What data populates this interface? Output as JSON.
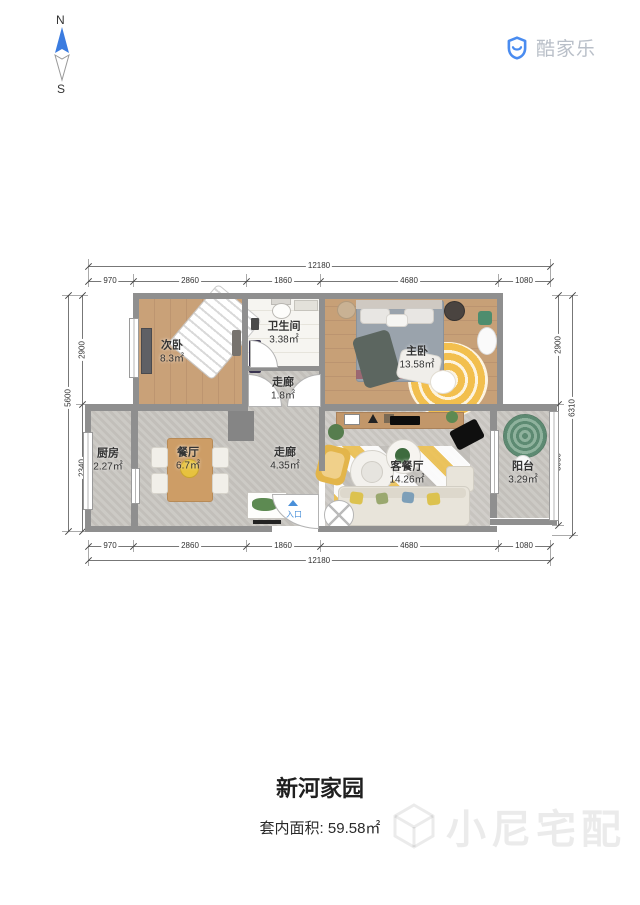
{
  "compass": {
    "north": "N",
    "south": "S"
  },
  "brand": {
    "name": "酷家乐"
  },
  "plan": {
    "rooms": {
      "second_bedroom": {
        "name": "次卧",
        "area": "8.3㎡"
      },
      "bathroom": {
        "name": "卫生间",
        "area": "3.38㎡"
      },
      "master_bedroom": {
        "name": "主卧",
        "area": "13.58㎡"
      },
      "hallway_small": {
        "name": "走廊",
        "area": "1.8㎡"
      },
      "kitchen": {
        "name": "厨房",
        "area": "2.27㎡"
      },
      "dining": {
        "name": "餐厅",
        "area": "6.7㎡"
      },
      "hallway": {
        "name": "走廊",
        "area": "4.35㎡"
      },
      "living_dining": {
        "name": "客餐厅",
        "area": "14.26㎡"
      },
      "balcony": {
        "name": "阳台",
        "area": "3.29㎡"
      }
    },
    "entrance": {
      "label": "入口"
    },
    "dims": {
      "top_total": "12180",
      "top_segments": [
        "970",
        "2860",
        "1860",
        "4680",
        "1080"
      ],
      "bottom_total": "12180",
      "bottom_segments": [
        "970",
        "2860",
        "1860",
        "4680",
        "1080"
      ],
      "left_total": "5600",
      "left_segments": [
        "2900",
        "2340"
      ],
      "right_total": "6310",
      "right_segments": [
        "2900",
        "3050"
      ]
    }
  },
  "footer": {
    "title": "新河家园",
    "area_label": "套内面积:",
    "area_value": "59.58㎡",
    "watermark": "小尼宅配"
  },
  "colors": {
    "accent_blue": "#4a8cf0",
    "wall": "#8f8f8f",
    "entrance_blue": "#4a90d9"
  }
}
